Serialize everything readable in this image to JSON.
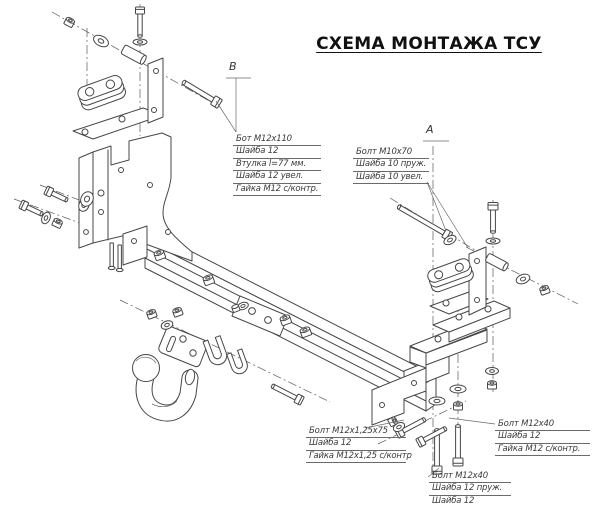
{
  "title": "СХЕМА МОНТАЖА ТСУ",
  "section_markers": {
    "b": "В",
    "a": "А"
  },
  "callouts": {
    "bolt_b": {
      "lines": [
        "Бот  M12х110",
        "Шайба 12",
        "Втулка l=77 мм.",
        "Шайба 12 увел.",
        "Гайка М12 с/контр."
      ]
    },
    "bolt_a": {
      "lines": [
        "Болт  М10х70",
        "Шайба 10 пруж.",
        "Шайба 10 увел."
      ]
    },
    "bolt_center": {
      "lines": [
        "Болт  М12х1,25х75",
        "Шайба 12",
        "Гайка М12х1,25 с/контр"
      ]
    },
    "bolt_right": {
      "lines": [
        "Болт  М12х40",
        "Шайба 12",
        "Гайка М12 с/контр."
      ]
    },
    "bolt_bottom": {
      "lines": [
        "Болт  М12х40",
        "Шайба 12 пруж.",
        "Шайба 12"
      ]
    }
  },
  "colors": {
    "line": "#474747",
    "background": "#ffffff",
    "title_text": "#111111"
  }
}
